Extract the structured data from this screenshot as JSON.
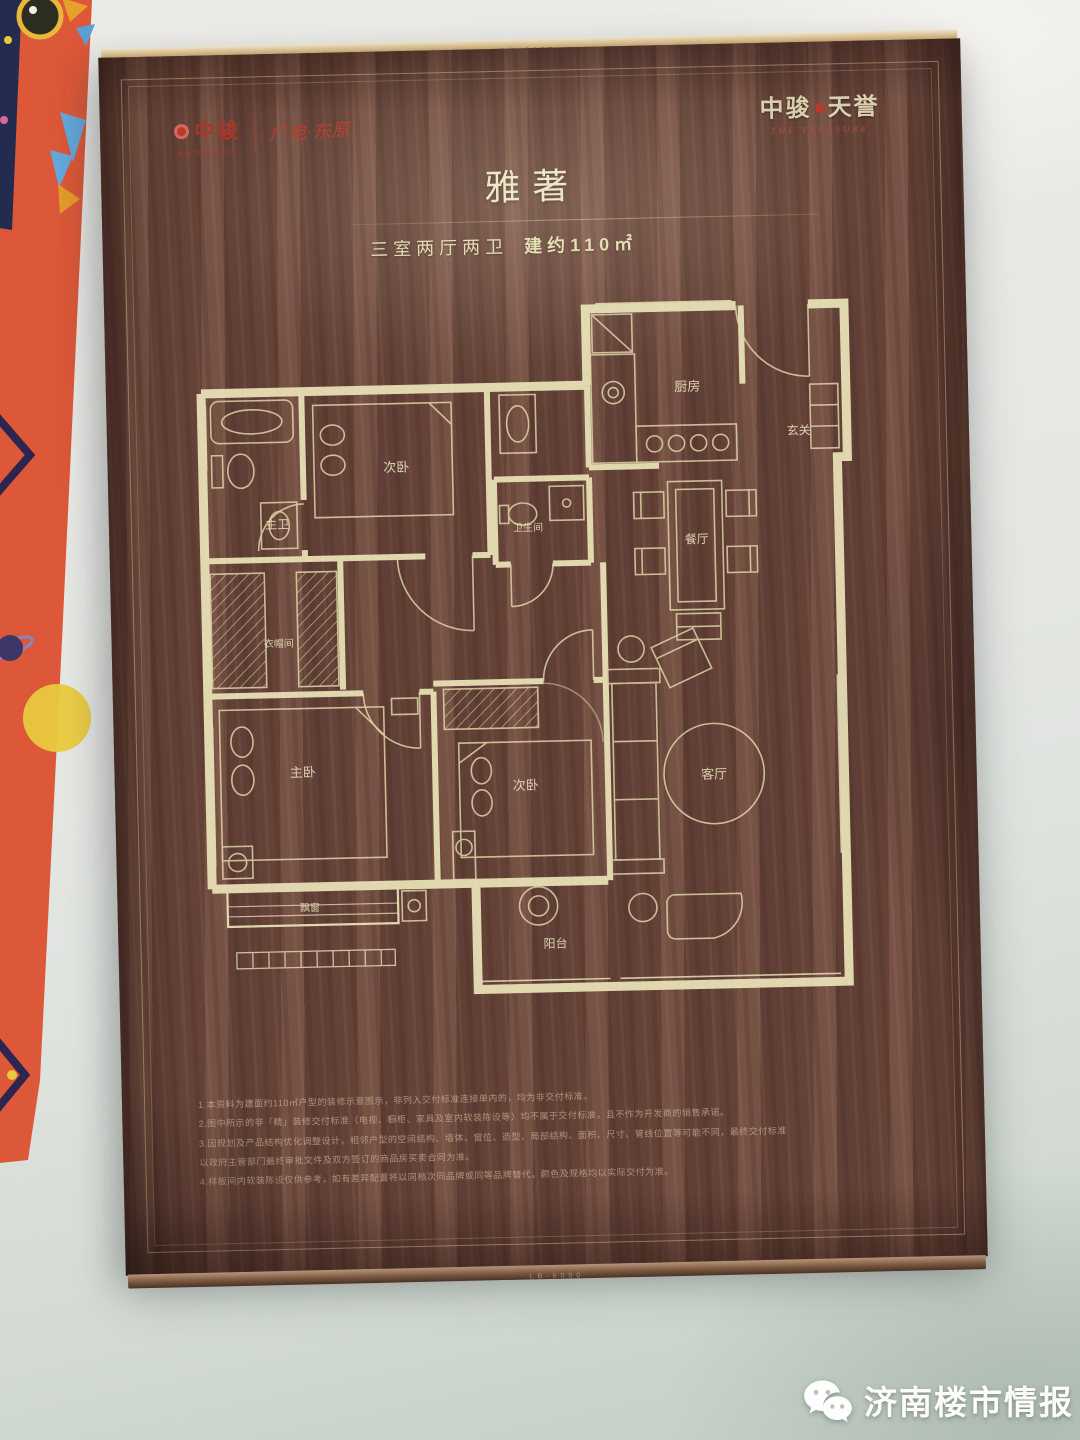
{
  "photo": {
    "watermark_label": "济南楼市情报",
    "watermark_icon": "wechat-icon"
  },
  "poster": {
    "edge_stamp": "LB-6000",
    "header": {
      "brand": "中骏",
      "brand_tagline": "美好生活服务商",
      "partner": "广电·东原",
      "project": "中骏",
      "project2": "天誉",
      "project_en": "THE TREASURE"
    },
    "title": {
      "name": "雅著",
      "spec": "三室两厅两卫",
      "area": "建约110㎡"
    },
    "floorplan": {
      "rooms": {
        "bedroom_top": "次卧",
        "master_bath": "主卫",
        "bathroom": "卫生间",
        "kitchen": "厨房",
        "foyer": "玄关",
        "dining": "餐厅",
        "closet": "衣帽间",
        "master_bedroom": "主卧",
        "bedroom_mid": "次卧",
        "living": "客厅",
        "balcony": "阳台",
        "bay_window": "飘窗"
      }
    },
    "notes": [
      "1.本资料为建面约110㎡户型的装修示意图示，非列入交付标准连接单内的，均为非交付标准。",
      "2.图中所示的非「精」装修交付标准（电视、橱柜、家具及室内软装陈设等）均不属于交付标准，且不作为开发商的销售承诺。",
      "3.因规划及产品结构优化调整设计，相邻户型的空间结构、墙体、窗位、造型、局部结构、面积、尺寸、管线位置等可能不同，最终交付标准",
      "以政府主管部门最终审批文件及双方签订的商品房买卖合同为准。",
      "4.样板间内软装陈设仅供参考，如有差异配置将以同档次同品牌或同等品牌替代，颜色及规格均以实际交付为准。"
    ]
  },
  "colors": {
    "board_brown": "#6f4c41",
    "plan_line_cream": "#e8e0b6",
    "logo_red": "#bd3a2b",
    "strip_orange": "#dd5a3a",
    "background_gray": "#e7e8e4"
  }
}
